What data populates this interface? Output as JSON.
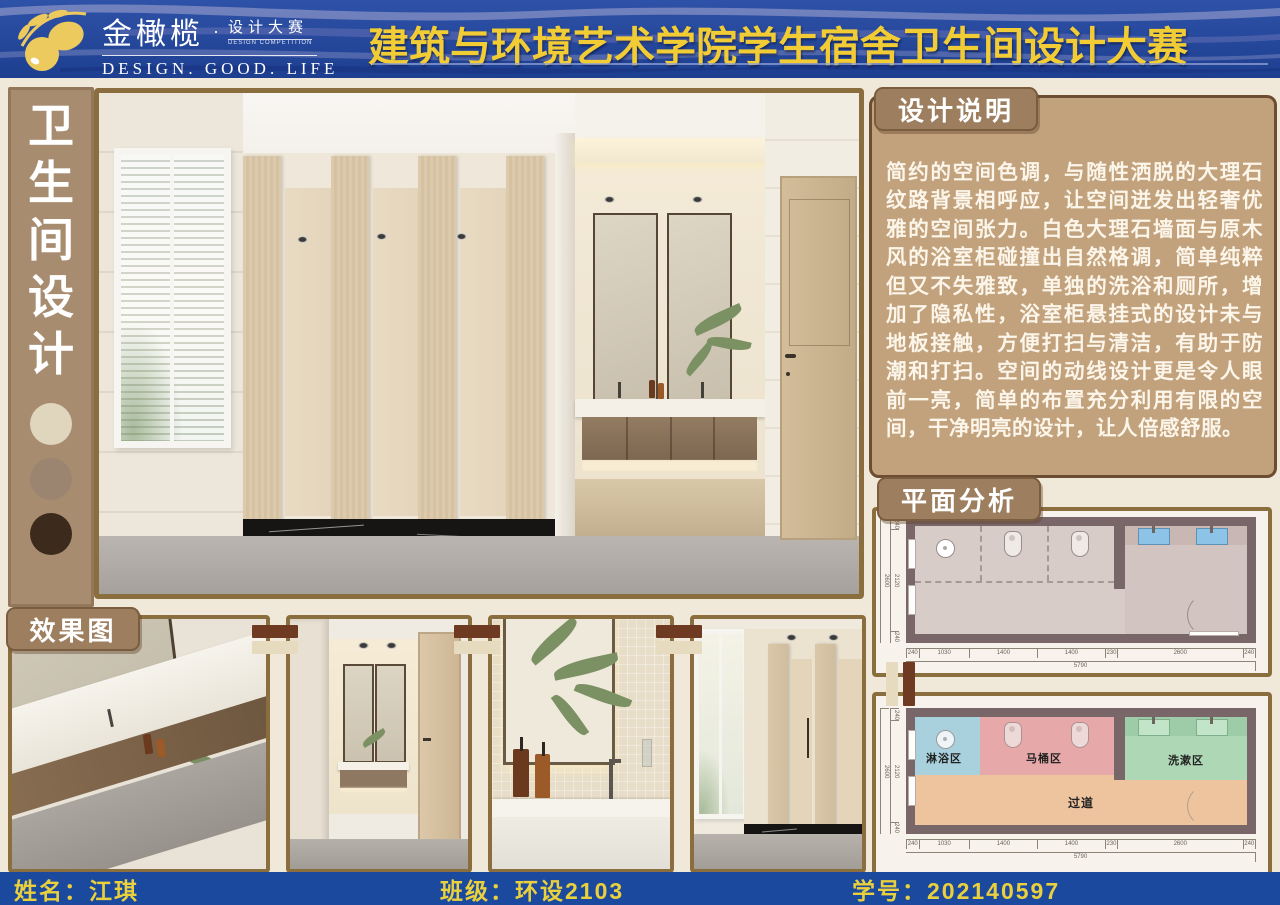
{
  "banner": {
    "brand": "金橄榄",
    "separator": "·",
    "brand_sub": "设计大赛",
    "brand_sub_tiny": "DESIGN COMPETITION",
    "tagline": "DESIGN.  GOOD.  LIFE",
    "title": "建筑与环境艺术学院学生宿舍卫生间设计大赛",
    "colors": {
      "banner_blue": "#24479c",
      "title_yellow": "#f2cc35"
    }
  },
  "sidebar": {
    "chars": [
      "卫",
      "生",
      "间",
      "设",
      "计"
    ],
    "dot_colors": [
      "#e0d5bd",
      "#9b8571",
      "#3c2a1d"
    ]
  },
  "design_notes": {
    "heading": "设计说明",
    "body": "简约的空间色调，与随性洒脱的大理石纹路背景相呼应，让空间迸发出轻奢优雅的空间张力。白色大理石墙面与原木风的浴室柜碰撞出自然格调，简单纯粹但又不失雅致，单独的洗浴和厕所，增加了隐私性，浴室柜悬挂式的设计未与地板接触，方便打扫与清洁，有助于防潮和打扫。空间的动线设计更是令人眼前一亮，简单的布置充分利用有限的空间，干净明亮的设计，让人倍感舒服。"
  },
  "plan_analysis": {
    "heading": "平面分析",
    "zones": [
      {
        "label": "淋浴区",
        "color": "#a8d0dd"
      },
      {
        "label": "马桶区",
        "color": "#e7a8aa"
      },
      {
        "label": "洗漱区",
        "color": "#aed7b5"
      },
      {
        "label": "过道",
        "color": "#eec49f"
      }
    ],
    "dims_bottom": [
      "240",
      "1030",
      "1400",
      "1400",
      "230",
      "2600",
      "240"
    ],
    "dims_bottom_total": "5790",
    "dims_left": [
      "240",
      "2120",
      "240"
    ],
    "dims_left_total": "2600"
  },
  "renders": {
    "heading": "效果图"
  },
  "footer": {
    "name_label": "姓名：",
    "name_value": "江琪",
    "class_label": "班级：",
    "class_value": "环设2103",
    "id_label": "学号：",
    "id_value": "202140597"
  }
}
